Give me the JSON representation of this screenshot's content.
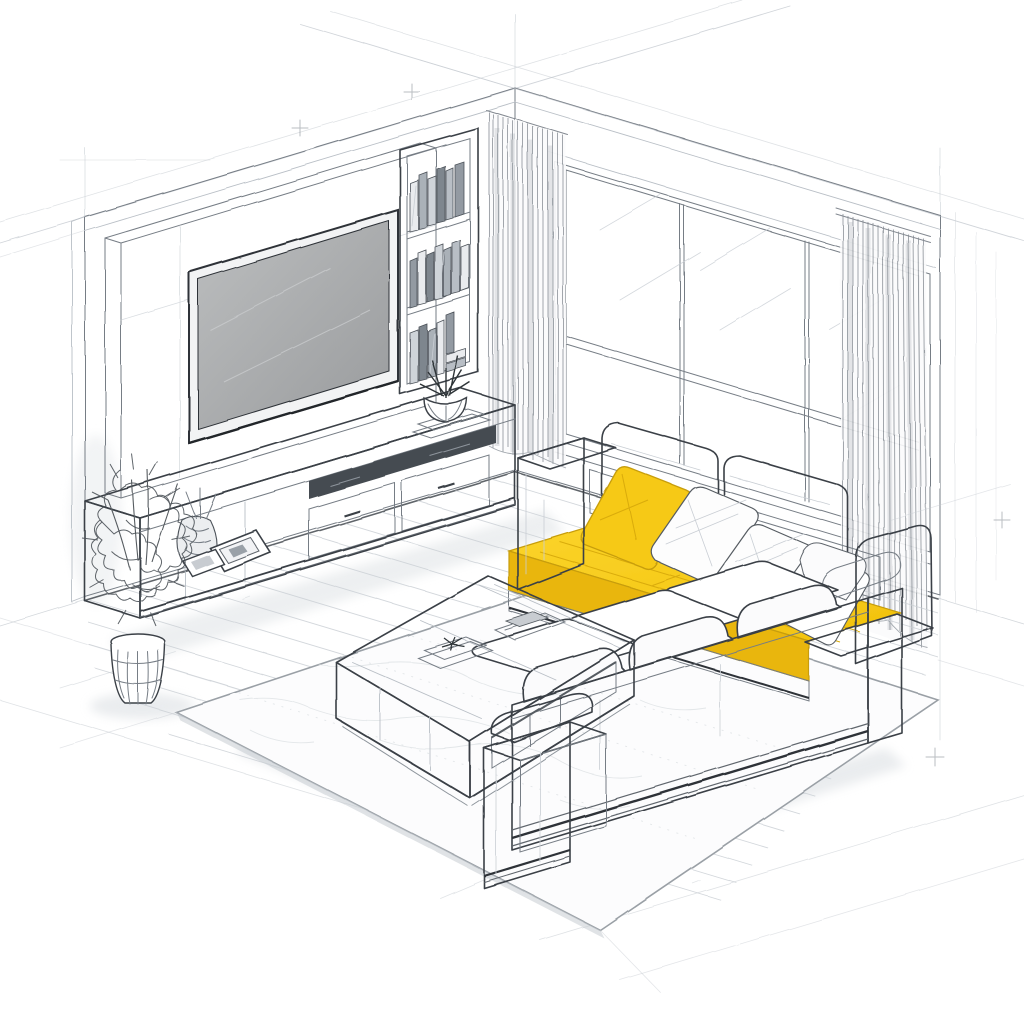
{
  "meta": {
    "title": "Isometric living room sketch with yellow accent sofa",
    "style": "hand-drawn architectural line illustration, white background, single yellow accent color",
    "canvas": {
      "width": 1024,
      "height": 1024
    }
  },
  "palette": {
    "background": "#ffffff",
    "line_strong": "#3a4046",
    "line_medium": "#767d85",
    "line_faint": "#b9bfc6",
    "line_sketch": "#c9ced4",
    "accent_yellow": "#f6c913",
    "accent_yellow_bright": "#fbd42a",
    "accent_yellow_side": "#e9b60a",
    "accent_yellow_shadow": "#cda108",
    "tv_screen_light": "#b7b9ba",
    "tv_screen_dark": "#9b9d9f",
    "tv_frame": "#2e3338",
    "shadow": "#e7eaec",
    "book_grays": [
      "#e9ebee",
      "#aab1b8",
      "#7e868e",
      "#cfd4d9",
      "#939aa2",
      "#b8bec5"
    ]
  },
  "scene": {
    "room": {
      "label": "Isometric corner of a living room, two walls and wood floor"
    },
    "walls": {
      "left": {
        "label": "Left wall with media unit"
      },
      "right": {
        "label": "Right wall with large window"
      }
    },
    "floor": {
      "label": "Wood plank floor",
      "plank_direction": "parallel to right wall"
    },
    "rug": {
      "label": "Large light area rug under seating group"
    },
    "window": {
      "label": "Floor-to-ceiling window",
      "pane_columns": 3,
      "vertical_mullions": 2,
      "transom_rails": 1
    },
    "curtains": {
      "left": {
        "label": "Sheer curtain at window left / room corner"
      },
      "right": {
        "label": "Sheer curtain at window right end"
      }
    },
    "media_wall": {
      "label": "White media wall back panel"
    },
    "tv": {
      "label": "Wall-mounted flat TV",
      "state": "off"
    },
    "bookshelf": {
      "label": "Built-in open bookshelf",
      "shelves": 3,
      "books_per_shelf": [
        6,
        7,
        7
      ]
    },
    "succulent": {
      "label": "Succulent in round bowl on stacked books"
    },
    "console": {
      "label": "Long low TV console",
      "drawers": 2,
      "open_shelf_slots": 1
    },
    "frames": {
      "label": "Two leaning picture frames on console",
      "count": 2
    },
    "vase": {
      "label": "Woven vase with dried stems"
    },
    "floor_plant": {
      "label": "Tall potted plant in ribbed planter"
    },
    "coffee_table": {
      "label": "Square low coffee table with open shelf",
      "items": {
        "book_stacks": 2,
        "decor": 1
      }
    },
    "sofa": {
      "label": "L-shaped sectional sofa",
      "chaise": {
        "label": "Chaise section along window with yellow seat cushion",
        "seat_color": "#f6c913",
        "pillows": {
          "yellow": 1,
          "white": 4
        },
        "back_cushions": 2
      },
      "front": {
        "label": "Front sofa section seen from behind",
        "seat_cushions": 3,
        "back_cushions": 3,
        "arms": 1
      }
    },
    "construction": {
      "label": "Faint construction sketch lines extending past the room"
    }
  }
}
